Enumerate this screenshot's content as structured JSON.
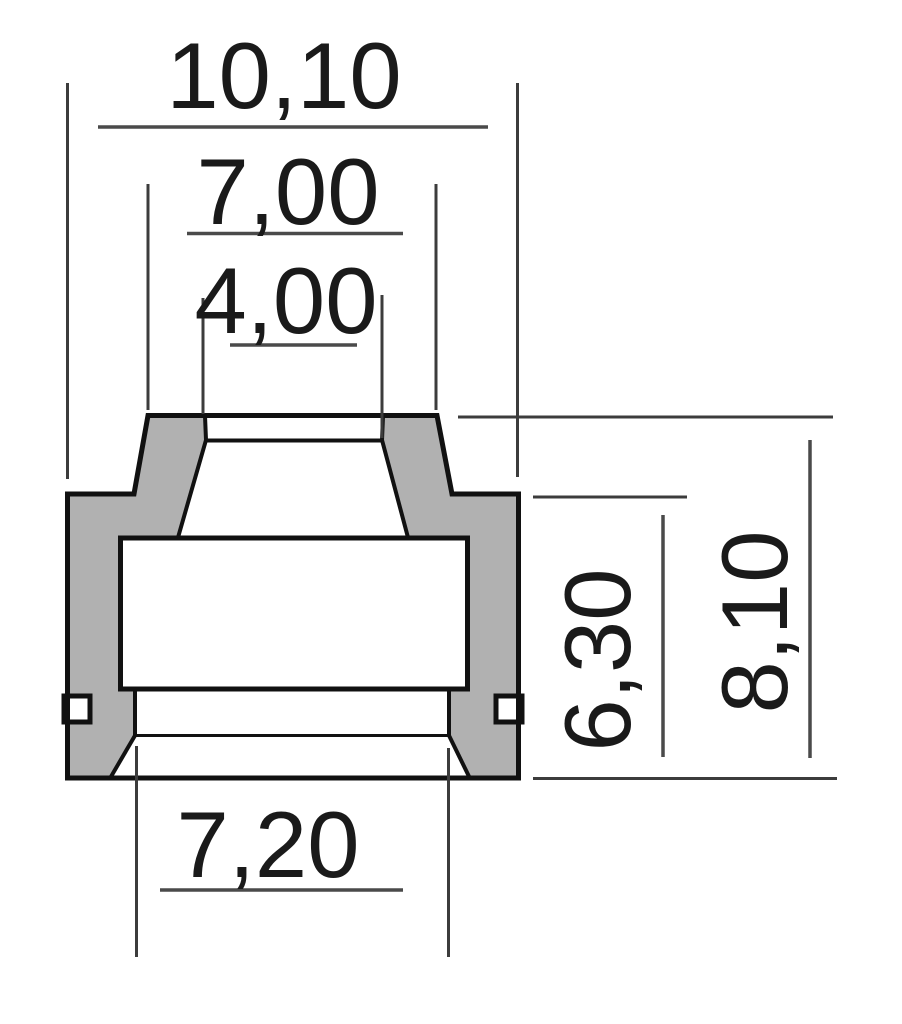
{
  "drawing": {
    "title": "valve-stem-seal-cross-section",
    "colors": {
      "rubber_fill": "#b1b1b1",
      "outline": "#111111",
      "dimension_line": "#4a4a4a",
      "text": "#1a1a1a",
      "background": "#ffffff"
    },
    "dimensions": {
      "outer_diameter": "10,10",
      "top_outer_diameter": "7,00",
      "stem_bore_diameter": "4,00",
      "bottom_bore_diameter": "7,20",
      "body_height": "6,30",
      "total_height": "8,10"
    }
  }
}
